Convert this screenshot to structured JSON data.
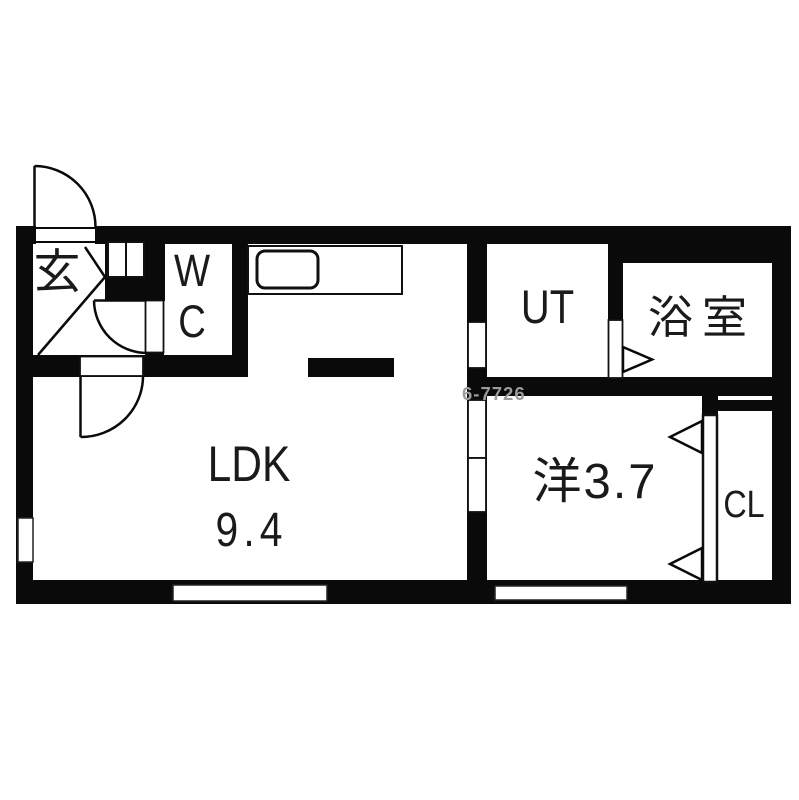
{
  "meta": {
    "title": "apartment floor plan",
    "type": "floor-plan-diagram"
  },
  "colors": {
    "wall": "#0a0a0a",
    "floor": "#ffffff",
    "text": "#1a1a1a",
    "watermark": "#9c9c9c"
  },
  "rooms": {
    "genkan": {
      "label": "玄"
    },
    "wc": {
      "line1": "W",
      "line2": "C"
    },
    "ldk": {
      "label": "LDK",
      "area": "9.4"
    },
    "ut": {
      "label": "UT"
    },
    "bath": {
      "label": "浴室"
    },
    "western": {
      "label": "洋3.7"
    },
    "closet": {
      "label": "CL"
    }
  },
  "watermark": {
    "text": "6-7726"
  }
}
